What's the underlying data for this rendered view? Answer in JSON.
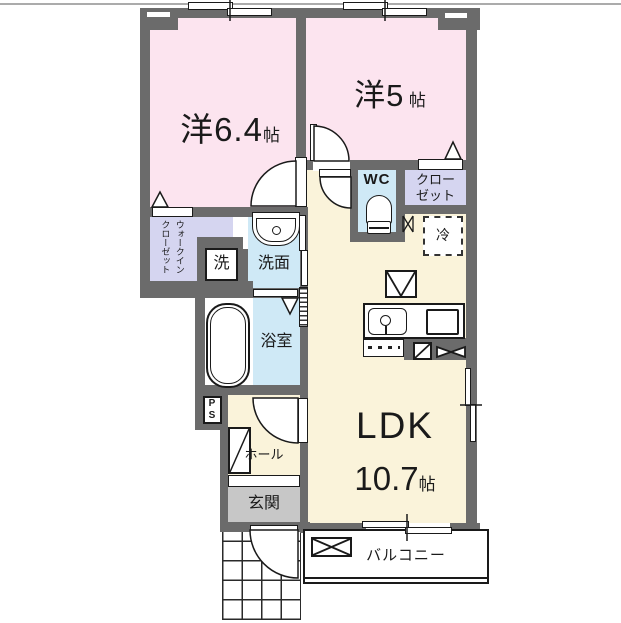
{
  "rooms": {
    "bedroom1": {
      "name": "洋6.4",
      "unit": "帖"
    },
    "bedroom2": {
      "name": "洋5",
      "unit": "帖"
    },
    "ldk": {
      "name": "LDK",
      "size": "10.7",
      "unit": "帖"
    },
    "wc": {
      "label": "WC"
    },
    "closet": {
      "label": "クロー\nゼット"
    },
    "walk_in_closet": {
      "label": "ウォークイン\nクローゼット"
    },
    "refrigerator": {
      "label": "冷"
    },
    "washer": {
      "label": "洗"
    },
    "washroom": {
      "label": "洗面"
    },
    "bathroom": {
      "label": "浴室"
    },
    "pipe_space": {
      "label": "PS"
    },
    "hall": {
      "label": "ホール"
    },
    "entrance": {
      "label": "玄関"
    },
    "balcony": {
      "label": "バルコニー"
    }
  },
  "colors": {
    "wall": "#6b6b6b",
    "room_pink": "#fce4ef",
    "closet_purple": "#d5d5f0",
    "water_blue": "#cfe9f6",
    "ldk_cream": "#faf3da",
    "entrance_gray": "#c7c7c7",
    "line_black": "#1a1a1a"
  }
}
